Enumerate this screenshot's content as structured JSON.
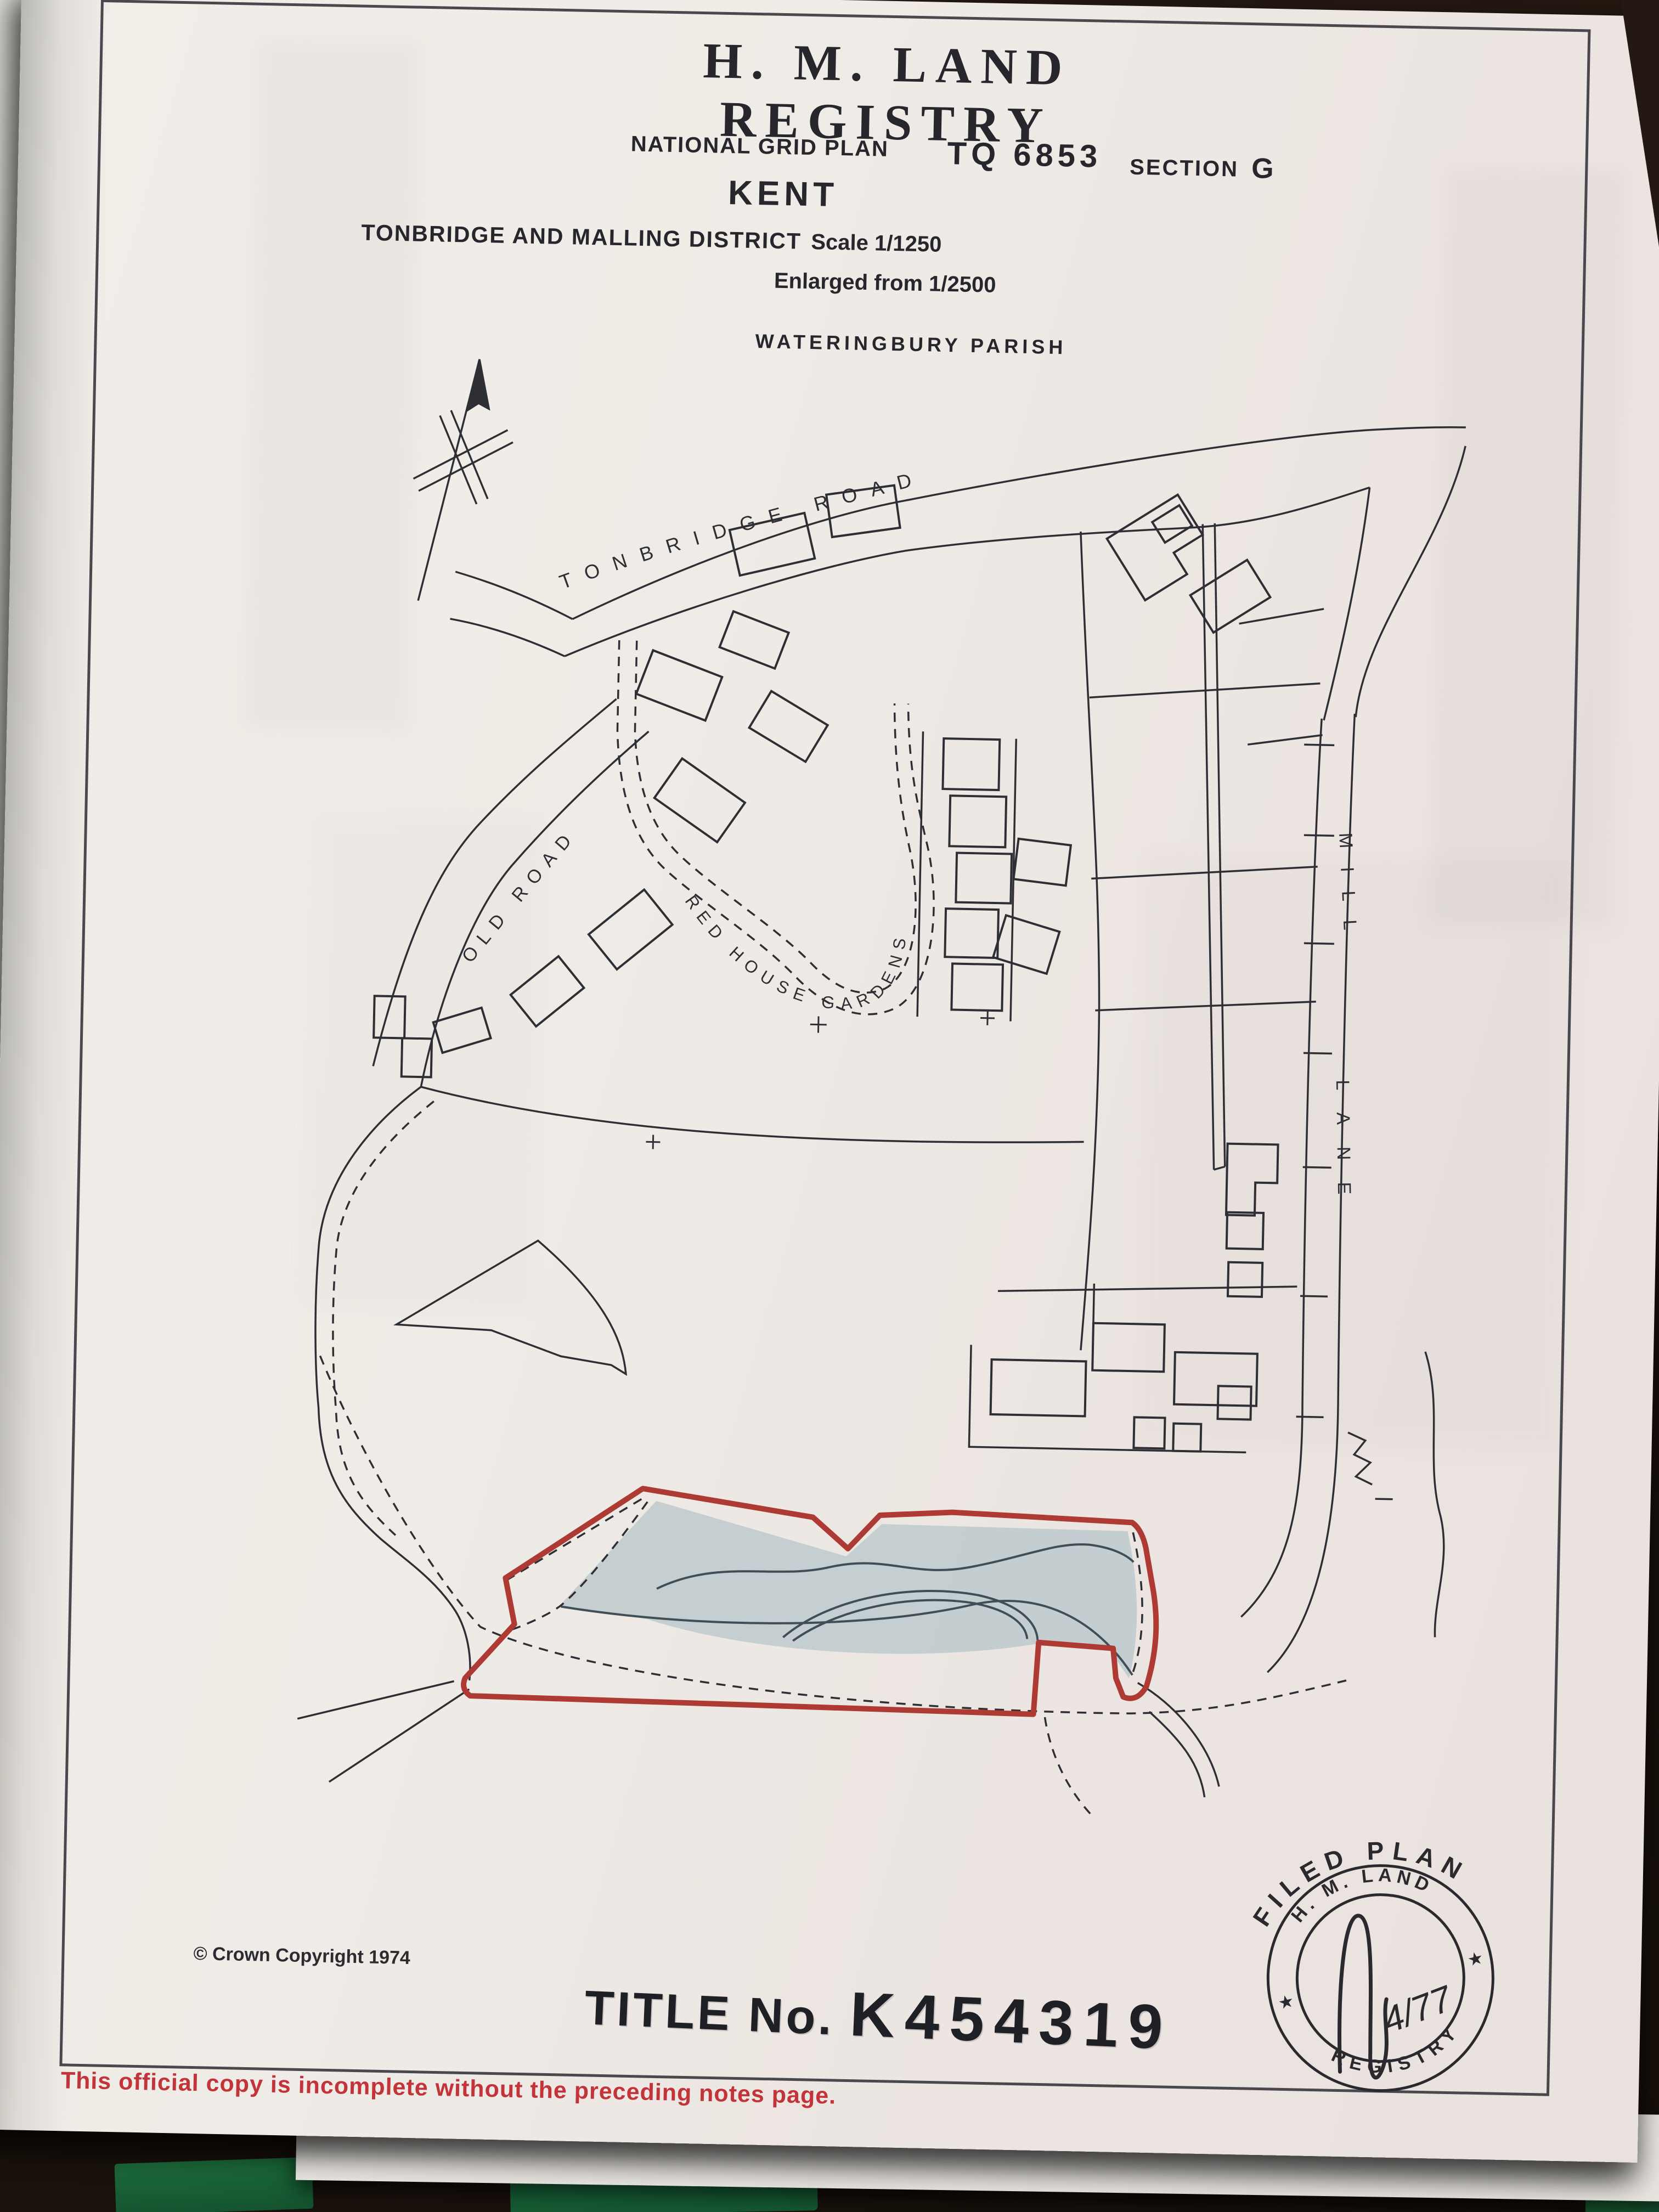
{
  "header": {
    "title": "H. M. LAND REGISTRY",
    "national_grid": "NATIONAL GRID PLAN",
    "grid_ref": "TQ 6853",
    "section_label": "SECTION",
    "section_value": "G",
    "county": "KENT",
    "district": "TONBRIDGE AND MALLING DISTRICT",
    "scale": "Scale 1/1250",
    "enlarged": "Enlarged from 1/2500",
    "parish": "WATERINGBURY PARISH"
  },
  "map": {
    "tonbridge_road": "TONBRIDGE ROAD",
    "old_road": "OLD ROAD",
    "red_house_gardens": "RED HOUSE GARDENS",
    "mill": "MILL",
    "lane": "LANE"
  },
  "footer": {
    "copyright": "© Crown Copyright 1974",
    "title_no_label": "TITLE No.",
    "title_no_value": "K454319",
    "warning": "This official copy is incomplete without the preceding notes page."
  },
  "stamp": {
    "arc_top": "FILED PLAN",
    "ring_top": "H. M. LAND",
    "ring_bottom": "REGISTRY",
    "star_left": "★",
    "star_right": "★",
    "signature_date": "4/77"
  },
  "colors": {
    "parcel_outline": "#ad3a33",
    "parcel_fill": "#b7c6ca",
    "map_ink": "#2e2e35",
    "warning_red": "#c2333a",
    "stamp_ink": "#2a2a2e"
  }
}
